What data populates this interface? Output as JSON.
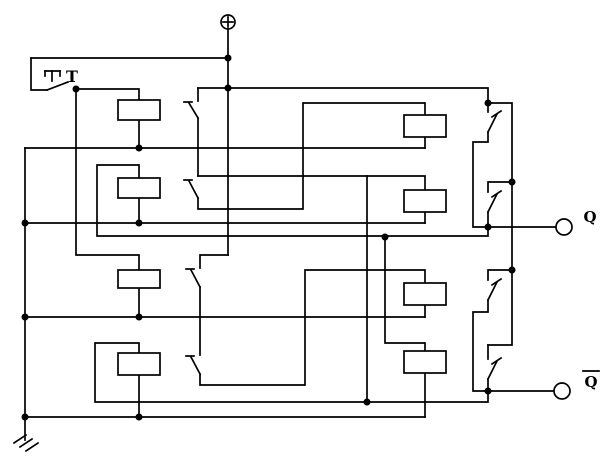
{
  "title": "T flip-flop relay trigger circuit schematic",
  "colors": {
    "line": "#000000",
    "background": "#ffffff"
  },
  "labels": {
    "trigger": "T",
    "q_output": "Q",
    "q_bar_output": "Q"
  },
  "circuit": {
    "stroke_width": 1.7,
    "wires": [
      {
        "name": "top-feed-wire",
        "pts": [
          [
            31,
            58
          ],
          [
            228,
            58
          ]
        ]
      },
      {
        "name": "t-switch-feed",
        "pts": [
          [
            31,
            58
          ],
          [
            31,
            90
          ],
          [
            47,
            90
          ]
        ]
      },
      {
        "name": "t-switch-blade",
        "pts": [
          [
            47,
            90
          ],
          [
            68,
            82
          ]
        ]
      },
      {
        "name": "t-actuator-cap",
        "pts": [
          [
            45,
            71
          ],
          [
            60,
            71
          ]
        ]
      },
      {
        "name": "t-actuator-serif-left",
        "pts": [
          [
            45,
            71
          ],
          [
            45,
            76
          ]
        ]
      },
      {
        "name": "t-actuator-serif-right",
        "pts": [
          [
            60,
            71
          ],
          [
            60,
            76
          ]
        ]
      },
      {
        "name": "t-actuator-stem",
        "pts": [
          [
            52,
            71
          ],
          [
            52,
            81
          ]
        ]
      },
      {
        "name": "t-node-to-coil1-top",
        "pts": [
          [
            76,
            89
          ],
          [
            139,
            89
          ],
          [
            139,
            100
          ]
        ]
      },
      {
        "name": "t-node-to-coil3-top",
        "pts": [
          [
            76,
            89
          ],
          [
            76,
            255
          ],
          [
            139,
            255
          ],
          [
            139,
            270
          ]
        ]
      },
      {
        "name": "coil1-bottom-lead",
        "pts": [
          [
            139,
            120
          ],
          [
            139,
            148
          ]
        ]
      },
      {
        "name": "bus-y148",
        "pts": [
          [
            25,
            148
          ],
          [
            425,
            148
          ]
        ]
      },
      {
        "name": "r1a-bottom-lead",
        "pts": [
          [
            425,
            137
          ],
          [
            425,
            148
          ]
        ]
      },
      {
        "name": "left-ground-rail",
        "pts": [
          [
            25,
            148
          ],
          [
            25,
            440
          ]
        ]
      },
      {
        "name": "chain1-feed",
        "pts": [
          [
            198,
            88
          ],
          [
            488,
            88
          ],
          [
            488,
            103
          ]
        ]
      },
      {
        "name": "contact-a-in",
        "pts": [
          [
            198,
            88
          ],
          [
            198,
            101
          ]
        ]
      },
      {
        "name": "contact-a-blade",
        "pts": [
          [
            189,
            103
          ],
          [
            198,
            118
          ]
        ]
      },
      {
        "name": "contact-a-tick",
        "pts": [
          [
            184,
            102
          ],
          [
            192,
            102
          ]
        ]
      },
      {
        "name": "chain1-mid-vertical",
        "pts": [
          [
            198,
            118
          ],
          [
            198,
            176
          ]
        ]
      },
      {
        "name": "tap-to-r1b-top",
        "pts": [
          [
            198,
            176
          ],
          [
            425,
            176
          ],
          [
            425,
            190
          ]
        ]
      },
      {
        "name": "contact-b-blade",
        "pts": [
          [
            189,
            181
          ],
          [
            198,
            198
          ]
        ]
      },
      {
        "name": "contact-b-tick",
        "pts": [
          [
            184,
            180
          ],
          [
            192,
            180
          ]
        ]
      },
      {
        "name": "chain1-out-to-r1a-top",
        "pts": [
          [
            198,
            198
          ],
          [
            198,
            209
          ],
          [
            303,
            209
          ],
          [
            303,
            103
          ],
          [
            425,
            103
          ],
          [
            425,
            115
          ]
        ]
      },
      {
        "name": "r1b-bottom-lead",
        "pts": [
          [
            425,
            212
          ],
          [
            425,
            223
          ]
        ]
      },
      {
        "name": "ground-bus-y223",
        "pts": [
          [
            25,
            223
          ],
          [
            425,
            223
          ]
        ]
      },
      {
        "name": "coil2-bottom-lead",
        "pts": [
          [
            139,
            198
          ],
          [
            139,
            223
          ]
        ]
      },
      {
        "name": "coil2-top-wrap-q-bus",
        "pts": [
          [
            139,
            178
          ],
          [
            139,
            165
          ],
          [
            97,
            165
          ],
          [
            97,
            236
          ],
          [
            488,
            236
          ],
          [
            488,
            227
          ]
        ]
      },
      {
        "name": "power-to-chain2",
        "pts": [
          [
            228,
            255
          ],
          [
            200,
            255
          ],
          [
            200,
            268
          ]
        ]
      },
      {
        "name": "contact-c-blade",
        "pts": [
          [
            191,
            270
          ],
          [
            200,
            287
          ]
        ]
      },
      {
        "name": "contact-c-tick",
        "pts": [
          [
            186,
            269
          ],
          [
            194,
            269
          ]
        ]
      },
      {
        "name": "chain2-mid-vertical",
        "pts": [
          [
            200,
            287
          ],
          [
            200,
            355
          ]
        ]
      },
      {
        "name": "contact-d-blade",
        "pts": [
          [
            191,
            357
          ],
          [
            200,
            374
          ]
        ]
      },
      {
        "name": "contact-d-tick",
        "pts": [
          [
            186,
            356
          ],
          [
            194,
            356
          ]
        ]
      },
      {
        "name": "chain2-out-to-r2a-top",
        "pts": [
          [
            200,
            374
          ],
          [
            200,
            385
          ],
          [
            305,
            385
          ],
          [
            305,
            270
          ],
          [
            425,
            270
          ],
          [
            425,
            283
          ]
        ]
      },
      {
        "name": "r2a-bottom-lead",
        "pts": [
          [
            425,
            305
          ],
          [
            425,
            317
          ]
        ]
      },
      {
        "name": "ground-bus-y317",
        "pts": [
          [
            25,
            317
          ],
          [
            425,
            317
          ]
        ]
      },
      {
        "name": "coil3-bottom-lead",
        "pts": [
          [
            139,
            288
          ],
          [
            139,
            317
          ]
        ]
      },
      {
        "name": "coil4-top-wrap-qbar-bus",
        "pts": [
          [
            139,
            353
          ],
          [
            139,
            343
          ],
          [
            95,
            343
          ],
          [
            95,
            402
          ],
          [
            488,
            402
          ],
          [
            488,
            391
          ]
        ]
      },
      {
        "name": "coil4-bottom-lead",
        "pts": [
          [
            139,
            375
          ],
          [
            139,
            417
          ]
        ]
      },
      {
        "name": "ground-bus-y417",
        "pts": [
          [
            25,
            417
          ],
          [
            425,
            417
          ]
        ]
      },
      {
        "name": "r2b-bottom-lead",
        "pts": [
          [
            425,
            373
          ],
          [
            425,
            417
          ]
        ]
      },
      {
        "name": "q-to-r2b-coupling",
        "pts": [
          [
            385,
            237
          ],
          [
            385,
            343
          ],
          [
            425,
            343
          ],
          [
            425,
            351
          ]
        ]
      },
      {
        "name": "tap-to-qbar-coupling",
        "pts": [
          [
            367,
            176
          ],
          [
            367,
            402
          ]
        ]
      },
      {
        "name": "right-rail",
        "pts": [
          [
            488,
            103
          ],
          [
            512,
            103
          ],
          [
            512,
            345
          ],
          [
            488,
            345
          ]
        ]
      },
      {
        "name": "contact-u1-in",
        "pts": [
          [
            488,
            103
          ],
          [
            488,
            112
          ]
        ]
      },
      {
        "name": "contact-u1-blade",
        "pts": [
          [
            497,
            114
          ],
          [
            488,
            132
          ]
        ]
      },
      {
        "name": "contact-u1-tick",
        "pts": [
          [
            492,
            117
          ],
          [
            501,
            111
          ]
        ]
      },
      {
        "name": "contact-u1-out",
        "pts": [
          [
            488,
            132
          ],
          [
            488,
            142
          ],
          [
            473,
            142
          ],
          [
            473,
            227
          ],
          [
            488,
            227
          ]
        ]
      },
      {
        "name": "contact-u2-in",
        "pts": [
          [
            512,
            182
          ],
          [
            488,
            182
          ],
          [
            488,
            192
          ]
        ]
      },
      {
        "name": "contact-u2-blade",
        "pts": [
          [
            497,
            194
          ],
          [
            488,
            212
          ]
        ]
      },
      {
        "name": "contact-u2-tick",
        "pts": [
          [
            492,
            197
          ],
          [
            501,
            191
          ]
        ]
      },
      {
        "name": "contact-u2-out",
        "pts": [
          [
            488,
            212
          ],
          [
            488,
            227
          ]
        ]
      },
      {
        "name": "contact-l1-in",
        "pts": [
          [
            512,
            270
          ],
          [
            488,
            270
          ],
          [
            488,
            280
          ]
        ]
      },
      {
        "name": "contact-l1-blade",
        "pts": [
          [
            497,
            282
          ],
          [
            488,
            300
          ]
        ]
      },
      {
        "name": "contact-l1-tick",
        "pts": [
          [
            492,
            285
          ],
          [
            501,
            279
          ]
        ]
      },
      {
        "name": "contact-l1-out",
        "pts": [
          [
            488,
            300
          ],
          [
            488,
            312
          ],
          [
            473,
            312
          ],
          [
            473,
            391
          ],
          [
            488,
            391
          ]
        ]
      },
      {
        "name": "contact-l2-in",
        "pts": [
          [
            488,
            345
          ],
          [
            488,
            359
          ]
        ]
      },
      {
        "name": "contact-l2-blade",
        "pts": [
          [
            497,
            361
          ],
          [
            488,
            379
          ]
        ]
      },
      {
        "name": "contact-l2-tick",
        "pts": [
          [
            492,
            364
          ],
          [
            501,
            358
          ]
        ]
      },
      {
        "name": "contact-l2-out",
        "pts": [
          [
            488,
            379
          ],
          [
            488,
            391
          ]
        ]
      },
      {
        "name": "q-output-wire",
        "pts": [
          [
            488,
            227
          ],
          [
            556,
            227
          ]
        ]
      },
      {
        "name": "qbar-output-wire",
        "pts": [
          [
            488,
            391
          ],
          [
            554,
            391
          ]
        ]
      },
      {
        "name": "qbar-overbar",
        "pts": [
          [
            583,
            371
          ],
          [
            599,
            371
          ]
        ]
      },
      {
        "name": "power-plus-v",
        "pts": [
          [
            228,
            17
          ],
          [
            228,
            27
          ]
        ]
      },
      {
        "name": "power-plus-h",
        "pts": [
          [
            223,
            22
          ],
          [
            233,
            22
          ]
        ]
      },
      {
        "name": "power-rail",
        "pts": [
          [
            228,
            29
          ],
          [
            228,
            255
          ]
        ]
      }
    ],
    "boxes": [
      {
        "name": "coil1-box",
        "x": 118,
        "y": 100,
        "w": 42,
        "h": 20
      },
      {
        "name": "coil2-box",
        "x": 118,
        "y": 178,
        "w": 42,
        "h": 20
      },
      {
        "name": "coil3-box",
        "x": 118,
        "y": 270,
        "w": 42,
        "h": 18
      },
      {
        "name": "coil4-box",
        "x": 118,
        "y": 353,
        "w": 42,
        "h": 22
      },
      {
        "name": "r1a-box",
        "x": 404,
        "y": 115,
        "w": 42,
        "h": 22
      },
      {
        "name": "r1b-box",
        "x": 404,
        "y": 190,
        "w": 42,
        "h": 22
      },
      {
        "name": "r2a-box",
        "x": 404,
        "y": 283,
        "w": 42,
        "h": 22
      },
      {
        "name": "r2b-box",
        "x": 404,
        "y": 351,
        "w": 42,
        "h": 22
      }
    ],
    "dots": [
      [
        228,
        58
      ],
      [
        228,
        88
      ],
      [
        76,
        89
      ],
      [
        139,
        148
      ],
      [
        25,
        223
      ],
      [
        139,
        223
      ],
      [
        25,
        317
      ],
      [
        139,
        317
      ],
      [
        25,
        417
      ],
      [
        139,
        417
      ],
      [
        385,
        237
      ],
      [
        367,
        402
      ],
      [
        488,
        103
      ],
      [
        512,
        182
      ],
      [
        512,
        270
      ],
      [
        488,
        227
      ],
      [
        488,
        391
      ]
    ],
    "dot_radius": 3.5,
    "power": {
      "name": "power-plus-icon",
      "cx": 228,
      "cy": 22,
      "r": 7
    },
    "ground": {
      "name": "ground-icon",
      "strokes": [
        [
          [
            14,
            443
          ],
          [
            26,
            435
          ]
        ],
        [
          [
            20,
            447
          ],
          [
            32,
            439
          ]
        ],
        [
          [
            26,
            451
          ],
          [
            38,
            443
          ]
        ]
      ]
    },
    "terminals": [
      {
        "name": "q-terminal",
        "cx": 564,
        "cy": 227,
        "r": 8
      },
      {
        "name": "qbar-terminal",
        "cx": 562,
        "cy": 391,
        "r": 8
      }
    ],
    "texts": [
      {
        "name": "t-label",
        "key": "trigger",
        "x": 72,
        "y": 82,
        "size": 16
      },
      {
        "name": "q-label",
        "key": "q_output",
        "x": 590,
        "y": 222,
        "size": 15
      },
      {
        "name": "qbar-label",
        "key": "q_bar_output",
        "x": 591,
        "y": 387,
        "size": 15
      }
    ]
  }
}
